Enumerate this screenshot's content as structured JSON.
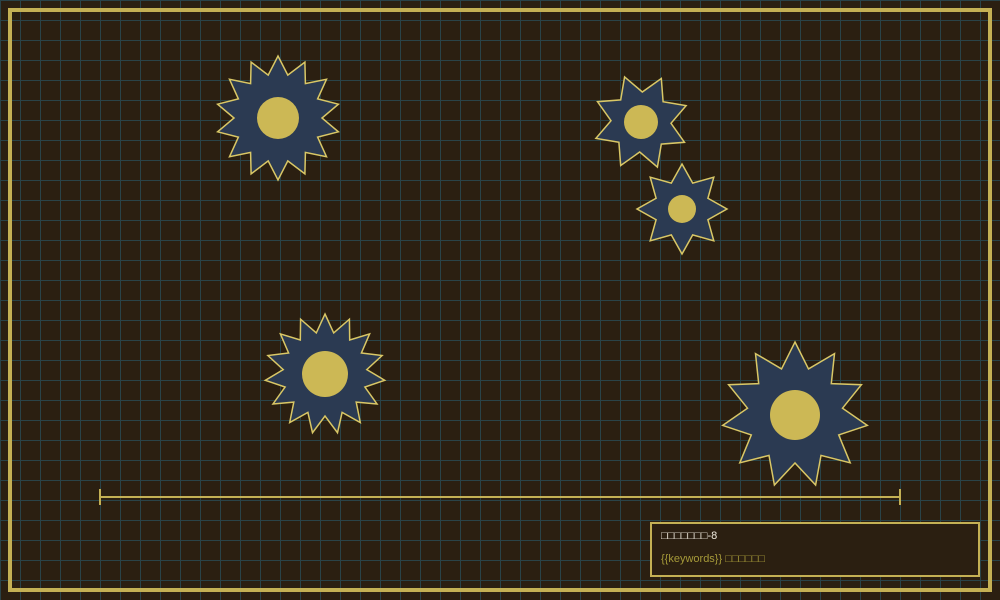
{
  "scene": {
    "background_color": "#2b1f11",
    "grid_color": "#2a4348",
    "grid_size": 20,
    "frame_color": "#c4b054",
    "star_fill_color": "#2b3a52",
    "star_stroke_color": "#d9c766",
    "star_core_color": "#ccb855"
  },
  "stars": [
    {
      "id": "gear-1",
      "cx": 278,
      "cy": 118,
      "outer_r": 62,
      "inner_r": 44,
      "points": 14,
      "rotation": -90,
      "core_r": 21
    },
    {
      "id": "gear-2",
      "cx": 641,
      "cy": 122,
      "outer_r": 48,
      "inner_r": 30,
      "points": 8,
      "rotation": -110,
      "core_r": 17
    },
    {
      "id": "gear-3",
      "cx": 682,
      "cy": 209,
      "outer_r": 45,
      "inner_r": 28,
      "points": 8,
      "rotation": -90,
      "core_r": 14
    },
    {
      "id": "gear-4",
      "cx": 325,
      "cy": 374,
      "outer_r": 60,
      "inner_r": 42,
      "points": 15,
      "rotation": -90,
      "core_r": 23
    },
    {
      "id": "gear-5",
      "cx": 795,
      "cy": 415,
      "outer_r": 73,
      "inner_r": 48,
      "points": 11,
      "rotation": -90,
      "core_r": 25
    }
  ],
  "measure_line": {
    "x1": 100,
    "x2": 900,
    "y": 497,
    "tick_top": 489,
    "tick_bottom": 505,
    "thickness": 2,
    "color": "#c4b054"
  },
  "info_box": {
    "title": "□□□□□□□-8",
    "subtitle": "{{keywords}} □□□□□□",
    "title_color": "#f0ebdf",
    "subtitle_color": "#a69a39",
    "border_color": "#c4b054"
  }
}
